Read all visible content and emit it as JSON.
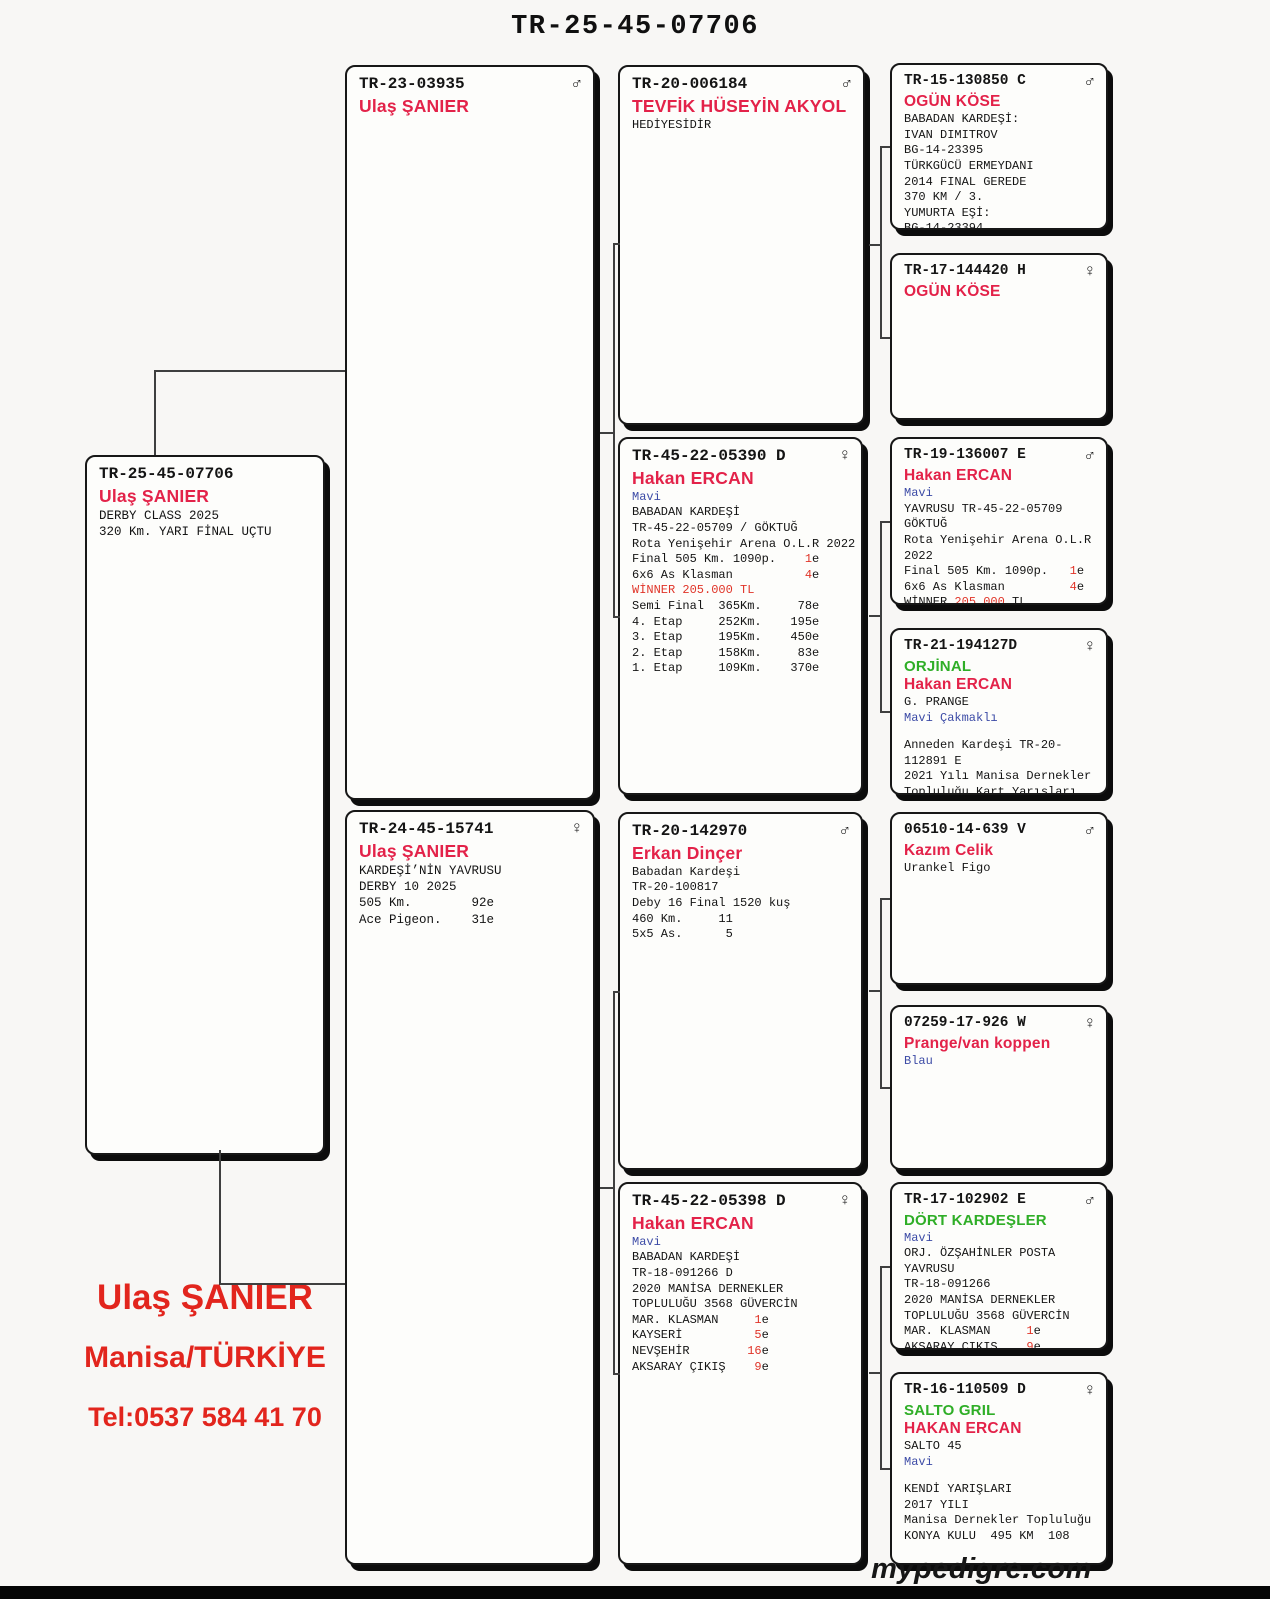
{
  "title": "TR-25-45-07706",
  "footer": {
    "owner": "Ulaş ŞANIER",
    "location": "Manisa/TÜRKİYE",
    "phone": "Tel:0537 584 41 70",
    "brand": "mypedigre.com"
  },
  "colors": {
    "name_red": "#e32249",
    "strain_green": "#2fae27",
    "color_blue": "#3c4ba6",
    "accent_red": "#e03428",
    "footer_red": "#e2251d"
  },
  "sex_glyphs": {
    "male": "♂",
    "female": "♀"
  },
  "boxes": [
    {
      "ring": "TR-25-45-07706",
      "sex": "",
      "names": [
        {
          "t": "Ulaş ŞANIER"
        }
      ],
      "lines": [
        [
          {
            "t": "DERBY CLASS 2025"
          }
        ],
        [
          {
            "t": "320 Km. YARI FİNAL UÇTU"
          }
        ]
      ]
    },
    {
      "ring": "TR-23-03935",
      "sex": "male",
      "names": [
        {
          "t": "Ulaş ŞANIER"
        }
      ],
      "lines": []
    },
    {
      "ring": "TR-24-45-15741",
      "sex": "female",
      "names": [
        {
          "t": "Ulaş ŞANIER"
        }
      ],
      "lines": [
        [
          {
            "t": "KARDEŞİ’NİN YAVRUSU"
          }
        ],
        [
          {
            "t": "DERBY 10 2025"
          }
        ],
        [
          {
            "t": "505 Km.        92e"
          }
        ],
        [
          {
            "t": "Ace Pigeon.    31e"
          }
        ]
      ]
    },
    {
      "ring": "TR-20-006184",
      "sex": "male",
      "names": [
        {
          "t": "TEVFİK HÜSEYİN AKYOL"
        }
      ],
      "lines": [
        [
          {
            "t": "HEDİYESİDİR"
          }
        ]
      ]
    },
    {
      "ring": "TR-45-22-05390 D",
      "sex": "female",
      "names": [
        {
          "t": "Hakan ERCAN"
        }
      ],
      "lines": [
        [
          {
            "t": "Mavi",
            "c": "b"
          }
        ],
        [
          {
            "t": "BABADAN KARDEŞİ"
          }
        ],
        [
          {
            "t": "TR-45-22-05709 / GÖKTUĞ"
          }
        ],
        [
          {
            "t": "Rota Yenişehir Arena O.L.R 2022"
          }
        ],
        [
          {
            "t": "Final 505 Km. 1090p.    "
          },
          {
            "t": "1",
            "c": "r"
          },
          {
            "t": "e"
          }
        ],
        [
          {
            "t": "6x6 As Klasman          "
          },
          {
            "t": "4",
            "c": "r"
          },
          {
            "t": "e"
          }
        ],
        [
          {
            "t": "WİNNER 205.000 TL",
            "c": "r"
          }
        ],
        [
          {
            "t": "Semi Final  365Km.     78e"
          }
        ],
        [
          {
            "t": "4. Etap     252Km.    195e"
          }
        ],
        [
          {
            "t": "3. Etap     195Km.    450e"
          }
        ],
        [
          {
            "t": "2. Etap     158Km.     83e"
          }
        ],
        [
          {
            "t": "1. Etap     109Km.    370e"
          }
        ]
      ]
    },
    {
      "ring": "TR-20-142970",
      "sex": "male",
      "names": [
        {
          "t": "Erkan Dinçer"
        }
      ],
      "lines": [
        [
          {
            "t": "Babadan Kardeşi"
          }
        ],
        [
          {
            "t": "TR-20-100817"
          }
        ],
        [
          {
            "t": "Deby 16 Final 1520 kuş"
          }
        ],
        [
          {
            "t": "460 Km.     11"
          }
        ],
        [
          {
            "t": "5x5 As.      5"
          }
        ]
      ]
    },
    {
      "ring": "TR-45-22-05398 D",
      "sex": "female",
      "names": [
        {
          "t": "Hakan ERCAN"
        }
      ],
      "lines": [
        [
          {
            "t": "Mavi",
            "c": "b"
          }
        ],
        [
          {
            "t": "BABADAN KARDEŞİ"
          }
        ],
        [
          {
            "t": "TR-18-091266 D"
          }
        ],
        [
          {
            "t": "2020 MANİSA DERNEKLER"
          }
        ],
        [
          {
            "t": "TOPLULUĞU 3568 GÜVERCİN"
          }
        ],
        [
          {
            "t": "MAR. KLASMAN     "
          },
          {
            "t": "1",
            "c": "r"
          },
          {
            "t": "e"
          }
        ],
        [
          {
            "t": "KAYSERİ          "
          },
          {
            "t": "5",
            "c": "r"
          },
          {
            "t": "e"
          }
        ],
        [
          {
            "t": "NEVŞEHİR        "
          },
          {
            "t": "16",
            "c": "r"
          },
          {
            "t": "e"
          }
        ],
        [
          {
            "t": "AKSARAY ÇIKIŞ    "
          },
          {
            "t": "9",
            "c": "r"
          },
          {
            "t": "e"
          }
        ]
      ]
    },
    {
      "ring": "TR-15-130850 C",
      "sex": "male",
      "names": [
        {
          "t": "OGÜN KÖSE"
        }
      ],
      "lines": [
        [
          {
            "t": "BABADAN KARDEŞİ:"
          }
        ],
        [
          {
            "t": "IVAN DIMITROV"
          }
        ],
        [
          {
            "t": "BG-14-23395"
          }
        ],
        [
          {
            "t": "TÜRKGÜCÜ ERMEYDANI"
          }
        ],
        [
          {
            "t": "2014 FINAL GEREDE"
          }
        ],
        [
          {
            "t": "370 KM / 3."
          }
        ],
        [
          {
            "t": "YUMURTA EŞİ:"
          }
        ],
        [
          {
            "t": "BG-14-23394"
          }
        ]
      ]
    },
    {
      "ring": "TR-17-144420 H",
      "sex": "female",
      "names": [
        {
          "t": "OGÜN KÖSE"
        }
      ],
      "lines": []
    },
    {
      "ring": "TR-19-136007 E",
      "sex": "male",
      "names": [
        {
          "t": "Hakan ERCAN"
        }
      ],
      "lines": [
        [
          {
            "t": "Mavi",
            "c": "b"
          }
        ],
        [
          {
            "t": "YAVRUSU TR-45-22-05709"
          }
        ],
        [
          {
            "t": "GÖKTUĞ"
          }
        ],
        [
          {
            "t": "Rota Yenişehir Arena O.L.R"
          }
        ],
        [
          {
            "t": "2022"
          }
        ],
        [
          {
            "t": "Final 505 Km. 1090p.   "
          },
          {
            "t": "1",
            "c": "r"
          },
          {
            "t": "e"
          }
        ],
        [
          {
            "t": "6x6 As Klasman         "
          },
          {
            "t": "4",
            "c": "r"
          },
          {
            "t": "e"
          }
        ],
        [
          {
            "t": "WİNNER "
          },
          {
            "t": "205.000",
            "c": "r"
          },
          {
            "t": " TL"
          }
        ]
      ]
    },
    {
      "ring": "TR-21-194127D",
      "sex": "female",
      "names": [
        {
          "t": "ORJİNAL",
          "s": "green"
        },
        {
          "t": "Hakan ERCAN"
        }
      ],
      "lines": [
        [
          {
            "t": "G. PRANGE"
          }
        ],
        [
          {
            "t": "Mavi Çakmaklı",
            "c": "b"
          }
        ],
        [],
        [
          {
            "t": "Anneden Kardeşi TR-20-"
          }
        ],
        [
          {
            "t": "112891 E"
          }
        ],
        [
          {
            "t": "2021 Yılı Manisa Dernekler"
          }
        ],
        [
          {
            "t": "Topluluğu Kart Yarışları"
          }
        ]
      ]
    },
    {
      "ring": "06510-14-639 V",
      "sex": "male",
      "names": [
        {
          "t": "Kazım Celik"
        }
      ],
      "lines": [
        [
          {
            "t": "Urankel Figo"
          }
        ]
      ]
    },
    {
      "ring": "07259-17-926 W",
      "sex": "female",
      "names": [
        {
          "t": "Prange/van koppen"
        }
      ],
      "lines": [
        [
          {
            "t": "Blau",
            "c": "b"
          }
        ]
      ]
    },
    {
      "ring": "TR-17-102902 E",
      "sex": "male",
      "names": [
        {
          "t": "DÖRT KARDEŞLER",
          "s": "green"
        }
      ],
      "lines": [
        [
          {
            "t": "Mavi",
            "c": "b"
          }
        ],
        [
          {
            "t": "ORJ. ÖZŞAHİNLER POSTA"
          }
        ],
        [
          {
            "t": "YAVRUSU"
          }
        ],
        [
          {
            "t": "TR-18-091266"
          }
        ],
        [
          {
            "t": "2020 MANİSA DERNEKLER"
          }
        ],
        [
          {
            "t": "TOPLULUĞU 3568 GÜVERCİN"
          }
        ],
        [
          {
            "t": "MAR. KLASMAN     "
          },
          {
            "t": "1",
            "c": "r"
          },
          {
            "t": "e"
          }
        ],
        [
          {
            "t": "AKSARAY ÇIKIŞ    "
          },
          {
            "t": "9",
            "c": "r"
          },
          {
            "t": "e"
          }
        ]
      ]
    },
    {
      "ring": "TR-16-110509 D",
      "sex": "female",
      "names": [
        {
          "t": "SALTO GRIL",
          "s": "green"
        },
        {
          "t": "HAKAN ERCAN"
        }
      ],
      "lines": [
        [
          {
            "t": "SALTO 45"
          }
        ],
        [
          {
            "t": "Mavi",
            "c": "b"
          }
        ],
        [],
        [
          {
            "t": "KENDİ YARIŞLARI"
          }
        ],
        [
          {
            "t": "2017 YILI"
          }
        ],
        [
          {
            "t": "Manisa Dernekler Topluluğu"
          }
        ],
        [
          {
            "t": "KONYA KULU  495 KM  108"
          }
        ]
      ]
    }
  ]
}
